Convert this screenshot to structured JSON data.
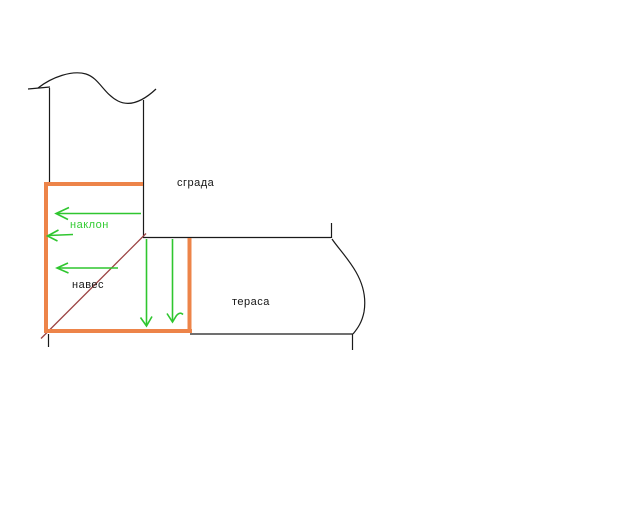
{
  "labels": {
    "building": "сграда",
    "slope": "наклон",
    "canopy": "навес",
    "terrace": "тераса"
  },
  "colors": {
    "background": "#ffffff",
    "ink": "#1a1a1a",
    "canopy_outline": "#ED8449",
    "arrow_green": "#2FC62F",
    "slope_label_green": "#33CC33",
    "roof_diagonal": "#9C4444",
    "stray_dot": "#4a4a4a"
  }
}
